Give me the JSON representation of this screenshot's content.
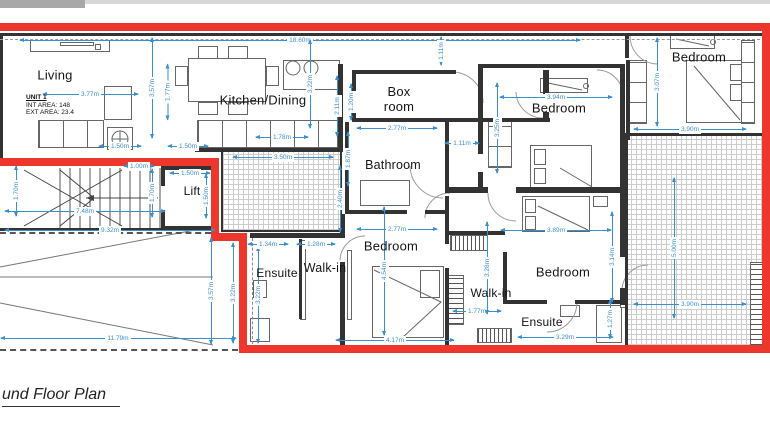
{
  "title": "und Floor Plan",
  "unit": {
    "name": "UNIT 1",
    "int_area": "INT AREA: 148",
    "ext_area": "EXT AREA: 23.4"
  },
  "colors": {
    "outline_red": "#ee372c",
    "wall": "#333333",
    "dimension_blue": "#3a8fd0"
  },
  "rooms": [
    {
      "name": "Living",
      "x": 55,
      "y": 75,
      "size": 13
    },
    {
      "name": "Kitchen/Dining",
      "x": 263,
      "y": 100,
      "size": 13
    },
    {
      "name": "Box\nroom",
      "x": 399,
      "y": 99,
      "size": 13
    },
    {
      "name": "Bathroom",
      "x": 393,
      "y": 165,
      "size": 12.5
    },
    {
      "name": "Lift",
      "x": 192,
      "y": 191,
      "size": 12
    },
    {
      "name": "Bedroom",
      "x": 559,
      "y": 108,
      "size": 13
    },
    {
      "name": "Bedroom",
      "x": 699,
      "y": 57,
      "size": 13
    },
    {
      "name": "Bedroom",
      "x": 391,
      "y": 246,
      "size": 13
    },
    {
      "name": "Bedroom",
      "x": 563,
      "y": 272,
      "size": 13
    },
    {
      "name": "Ensuite",
      "x": 277,
      "y": 273,
      "size": 12
    },
    {
      "name": "Walk-in",
      "x": 325,
      "y": 268,
      "size": 12.5
    },
    {
      "name": "Walk-in",
      "x": 491,
      "y": 293,
      "size": 12
    },
    {
      "name": "Ensuite",
      "x": 542,
      "y": 322,
      "size": 12
    }
  ],
  "dimensions": [
    {
      "text": "18.60m",
      "x": 300,
      "y": 40,
      "o": "h",
      "len": 560
    },
    {
      "text": "1.11m",
      "x": 441,
      "y": 51,
      "o": "v",
      "len": 28
    },
    {
      "text": "3.57m",
      "x": 152,
      "y": 88,
      "o": "v",
      "len": 100
    },
    {
      "text": "1.77m",
      "x": 167,
      "y": 92,
      "o": "v",
      "len": 55
    },
    {
      "text": "3.77m",
      "x": 90,
      "y": 94,
      "o": "h",
      "len": 95
    },
    {
      "text": "1.50m",
      "x": 120,
      "y": 146,
      "o": "h",
      "len": 42
    },
    {
      "text": "1.50m",
      "x": 188,
      "y": 146,
      "o": "h",
      "len": 40
    },
    {
      "text": "3.22m",
      "x": 310,
      "y": 84,
      "o": "v",
      "len": 88
    },
    {
      "text": "2.11m",
      "x": 337,
      "y": 106,
      "o": "v",
      "len": 60
    },
    {
      "text": "1.20m",
      "x": 351,
      "y": 102,
      "o": "v",
      "len": 36
    },
    {
      "text": "1.78m",
      "x": 282,
      "y": 137,
      "o": "h",
      "len": 52
    },
    {
      "text": "3.50m",
      "x": 283,
      "y": 157,
      "o": "h",
      "len": 100
    },
    {
      "text": "1.00m",
      "x": 139,
      "y": 166,
      "o": "h",
      "len": 30
    },
    {
      "text": "1.50m",
      "x": 190,
      "y": 173,
      "o": "h",
      "len": 40
    },
    {
      "text": "1.70m",
      "x": 152,
      "y": 193,
      "o": "v",
      "len": 48
    },
    {
      "text": "1.50m",
      "x": 206,
      "y": 196,
      "o": "v",
      "len": 44
    },
    {
      "text": "1.70m",
      "x": 16,
      "y": 191,
      "o": "v",
      "len": 50
    },
    {
      "text": "7.48m",
      "x": 85,
      "y": 211,
      "o": "h",
      "len": 160
    },
    {
      "text": "9.32m",
      "x": 110,
      "y": 230,
      "o": "h",
      "len": 210
    },
    {
      "text": "11.79m",
      "x": 118,
      "y": 338,
      "o": "h",
      "len": 235
    },
    {
      "text": "3.57m",
      "x": 211,
      "y": 291,
      "o": "v",
      "len": 106
    },
    {
      "text": "3.22m",
      "x": 233,
      "y": 293,
      "o": "v",
      "len": 100
    },
    {
      "text": "3.22m",
      "x": 258,
      "y": 295,
      "o": "v",
      "len": 96
    },
    {
      "text": "1.34m",
      "x": 268,
      "y": 244,
      "o": "h",
      "len": 40
    },
    {
      "text": "1.28m",
      "x": 316,
      "y": 244,
      "o": "h",
      "len": 38
    },
    {
      "text": "1.87m",
      "x": 348,
      "y": 159,
      "o": "v",
      "len": 54
    },
    {
      "text": "2.40m",
      "x": 340,
      "y": 199,
      "o": "v",
      "len": 66
    },
    {
      "text": "2.77m",
      "x": 397,
      "y": 128,
      "o": "h",
      "len": 80
    },
    {
      "text": "1.11m",
      "x": 462,
      "y": 143,
      "o": "h",
      "len": 34
    },
    {
      "text": "2.77m",
      "x": 397,
      "y": 229,
      "o": "h",
      "len": 80
    },
    {
      "text": "4.54m",
      "x": 384,
      "y": 271,
      "o": "v",
      "len": 128
    },
    {
      "text": "4.17m",
      "x": 395,
      "y": 340,
      "o": "h",
      "len": 118
    },
    {
      "text": "3.25m",
      "x": 497,
      "y": 128,
      "o": "v",
      "len": 90
    },
    {
      "text": "3.94m",
      "x": 556,
      "y": 97,
      "o": "h",
      "len": 112
    },
    {
      "text": "3.07m",
      "x": 657,
      "y": 82,
      "o": "v",
      "len": 88
    },
    {
      "text": "3.90m",
      "x": 690,
      "y": 129,
      "o": "h",
      "len": 112
    },
    {
      "text": "3.89m",
      "x": 556,
      "y": 230,
      "o": "h",
      "len": 110
    },
    {
      "text": "3.14m",
      "x": 612,
      "y": 257,
      "o": "v",
      "len": 90
    },
    {
      "text": "5.00m",
      "x": 674,
      "y": 248,
      "o": "v",
      "len": 140
    },
    {
      "text": "1.77m",
      "x": 477,
      "y": 311,
      "o": "h",
      "len": 48
    },
    {
      "text": "3.29m",
      "x": 565,
      "y": 337,
      "o": "h",
      "len": 95
    },
    {
      "text": "1.27m",
      "x": 610,
      "y": 319,
      "o": "v",
      "len": 38
    },
    {
      "text": "3.90m",
      "x": 690,
      "y": 304,
      "o": "h",
      "len": 112
    },
    {
      "text": "3.28m",
      "x": 487,
      "y": 268,
      "o": "v",
      "len": 92
    }
  ]
}
